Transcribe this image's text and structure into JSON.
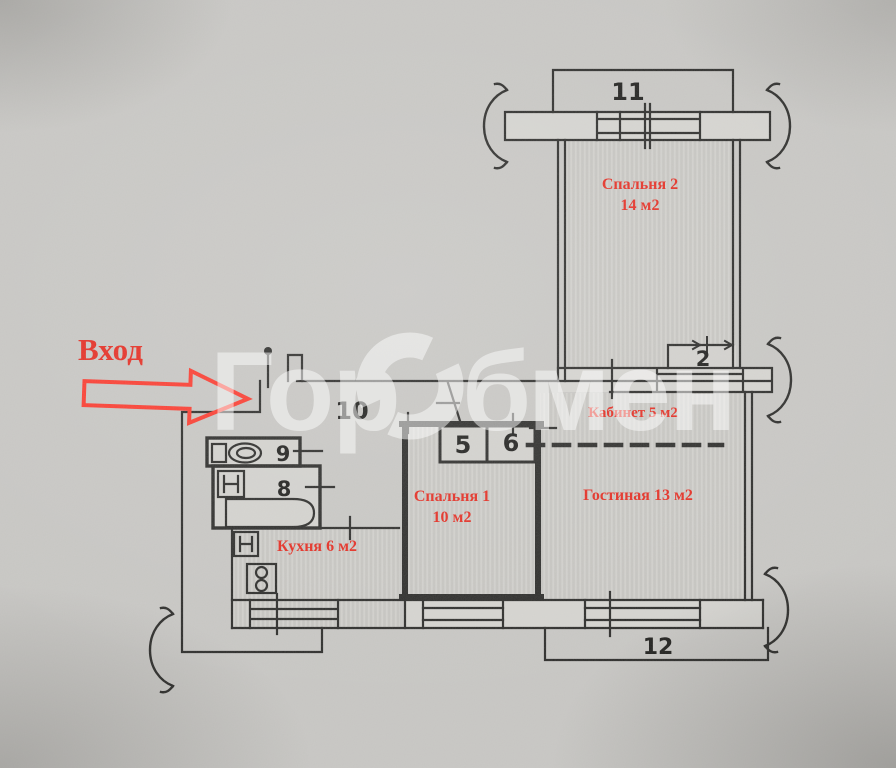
{
  "entrance": {
    "label": "Вход"
  },
  "watermark": {
    "full": "ГорОбмен",
    "left": "Гор",
    "right": "бмен"
  },
  "rooms": {
    "bedroom2": {
      "name": "Спальня 2",
      "area": "14 м2"
    },
    "office": {
      "name": "Кабинет 5 м2"
    },
    "bedroom1": {
      "name": "Спальня 1",
      "area": "10 м2"
    },
    "living": {
      "name": "Гостиная 13 м2"
    },
    "kitchen": {
      "name": "Кухня 6 м2"
    }
  },
  "numbers": {
    "balcony_top": "11",
    "closet_right": "2",
    "hallway": "10",
    "wc": "9",
    "bathroom": "8",
    "closet_a": "5",
    "closet_b": "6",
    "balcony_bottom": "12"
  },
  "colors": {
    "label_red": "#e32b20",
    "arrow_red": "#f93a2e",
    "line": "#2a2a28",
    "paper": "#c6c5c2",
    "watermark": "#ffffff"
  }
}
